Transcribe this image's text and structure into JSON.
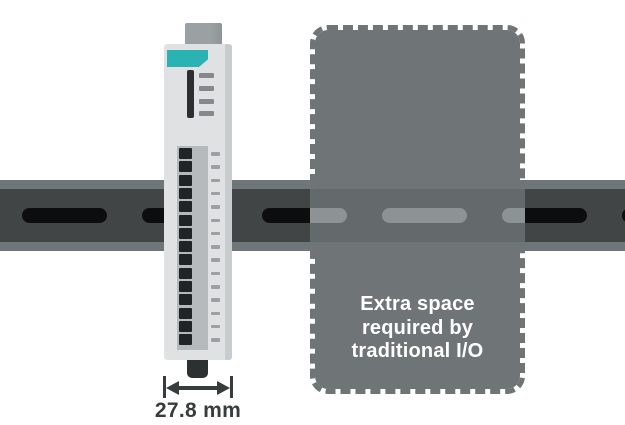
{
  "colors": {
    "page_bg": "#ffffff",
    "rail_strip": "#6e7678",
    "rail_band": "#424546",
    "rail_slot": "#0b0d0e",
    "block_fill": "#6f7577",
    "ghost_band": "#64696b",
    "ghost_slot": "#8d9395",
    "block_text": "#ffffff",
    "body": "#dfe1e2",
    "body_shade": "#c9ccce",
    "tab": "#9ba1a3",
    "tab_dark": "#8e9396",
    "teal": "#2bb3b3",
    "display_bar": "#2c2f30",
    "led": "#85898b",
    "terminal_bg": "#b6babc",
    "screw": "#212425",
    "terminal_label": "#9ca0a2",
    "clip": "#2d3031",
    "dim": "#393c3d"
  },
  "din_rail": {
    "slot_positions": [
      22,
      142,
      262,
      382,
      502,
      622
    ],
    "slot_width": 85
  },
  "extra_space_block": {
    "label_lines": [
      "Extra space",
      "required by",
      "traditional I/O"
    ],
    "left": 310,
    "right": 525
  },
  "device": {
    "led_count": 4,
    "led_spacing": 12.8,
    "terminal_count": 15,
    "terminal_spacing": 13.3,
    "label_count": 15,
    "label_spacing": 13.3
  },
  "dimension": {
    "label": "27.8 mm"
  }
}
